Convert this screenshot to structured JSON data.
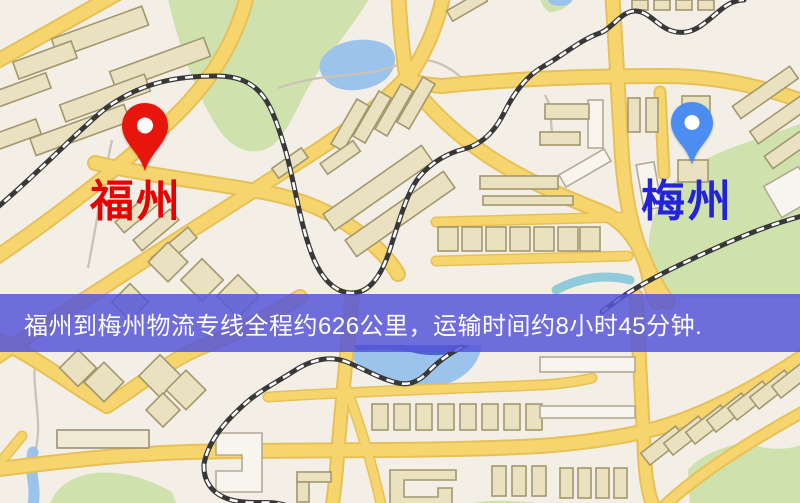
{
  "map": {
    "origin_marker": {
      "name": "福州",
      "label_color": "#e60000",
      "pin_color": "#e8150d"
    },
    "destination_marker": {
      "name": "梅州",
      "label_color": "#2323d9",
      "pin_color": "#4b8df0"
    },
    "banner": {
      "text": "福州到梅州物流专线全程约626公里，运输时间约8小时45分钟.",
      "bg_rgba": "rgba(86,86,216,0.85)",
      "bg_hex": "#5656d8",
      "text_color": "#ffffff"
    },
    "route_facts": {
      "origin": "福州",
      "destination": "梅州",
      "line_type": "物流专线",
      "distance_text": "约626公里",
      "duration_text": "约8小时45分钟"
    },
    "colors": {
      "land": "#f3efe6",
      "park": "#cfe2ad",
      "water": "#9cc3ec",
      "deep_water": "#4f63cf",
      "road_fill": "#f7d56e",
      "road_casing": "#e7c157",
      "building_fill": "#eae1c0",
      "building_stroke": "#a3976d",
      "railway": "#383838"
    }
  }
}
